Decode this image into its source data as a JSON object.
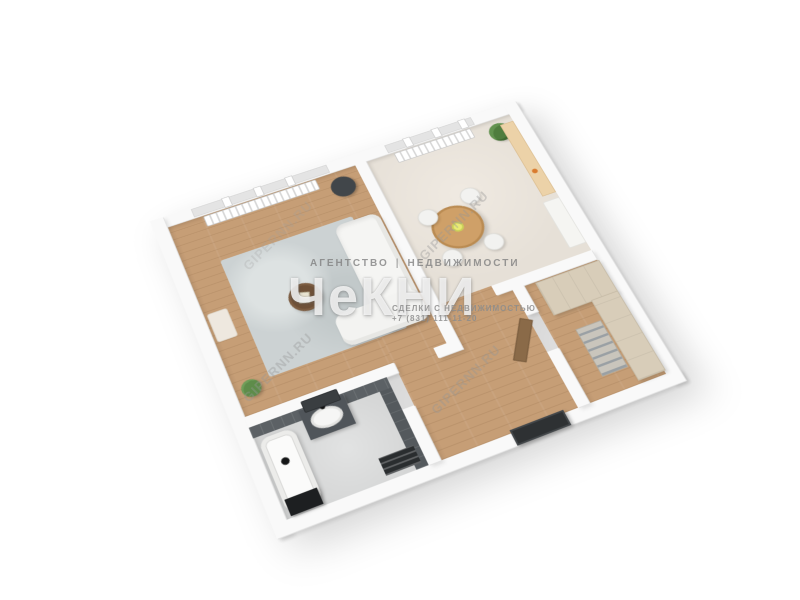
{
  "render": {
    "type": "3d-floor-plan",
    "background": "#ffffff"
  },
  "watermark_center": {
    "top_left": "АГЕНТСТВО",
    "divider": "|",
    "top_right": "НЕДВИЖИМОСТИ",
    "logo": "ЧеКНИ",
    "tagline": "СДЕЛКИ С НЕДВИЖИМОСТЬЮ",
    "phone": "+7 (831) 111-11-20"
  },
  "watermark_site": {
    "text": "GIPERNN.RU"
  },
  "colors": {
    "wood_floor": "#c69e76",
    "dining_floor": "#eae4db",
    "bathroom_floor": "#d8d9d9",
    "wall": "#f9f9f9",
    "dark_tile": "#5c6165",
    "kitchen_cabinet": "#d8cdb9",
    "wood_panel": "#ecd2a8",
    "dining_table": "#cfa068",
    "sofa": "#f5f5f3",
    "plant": "#5e8c4a",
    "door_dark": "#2e3133"
  },
  "rooms": [
    {
      "name": "living-room",
      "floor": "wood",
      "furniture": [
        "sofa",
        "rug",
        "coffee-table",
        "wall-tv",
        "radiator",
        "window",
        "floor-plant",
        "side-table"
      ]
    },
    {
      "name": "kitchen-dining-room",
      "floor": "light-laminate",
      "furniture": [
        "round-dining-table",
        "four-chairs",
        "radiator",
        "window",
        "plant",
        "wood-wall-panel",
        "console-cabinet"
      ]
    },
    {
      "name": "kitchen",
      "floor": "wood",
      "furniture": [
        "cabinet-block",
        "cabinet-run",
        "oven-front"
      ]
    },
    {
      "name": "bathroom",
      "floor": "grey-tile",
      "furniture": [
        "bathtub",
        "washing-machine",
        "vanity-sink",
        "mirror",
        "towel-radiator"
      ]
    },
    {
      "name": "hallway",
      "floor": "wood",
      "furniture": [
        "entrance-door",
        "open-interior-door"
      ]
    }
  ]
}
